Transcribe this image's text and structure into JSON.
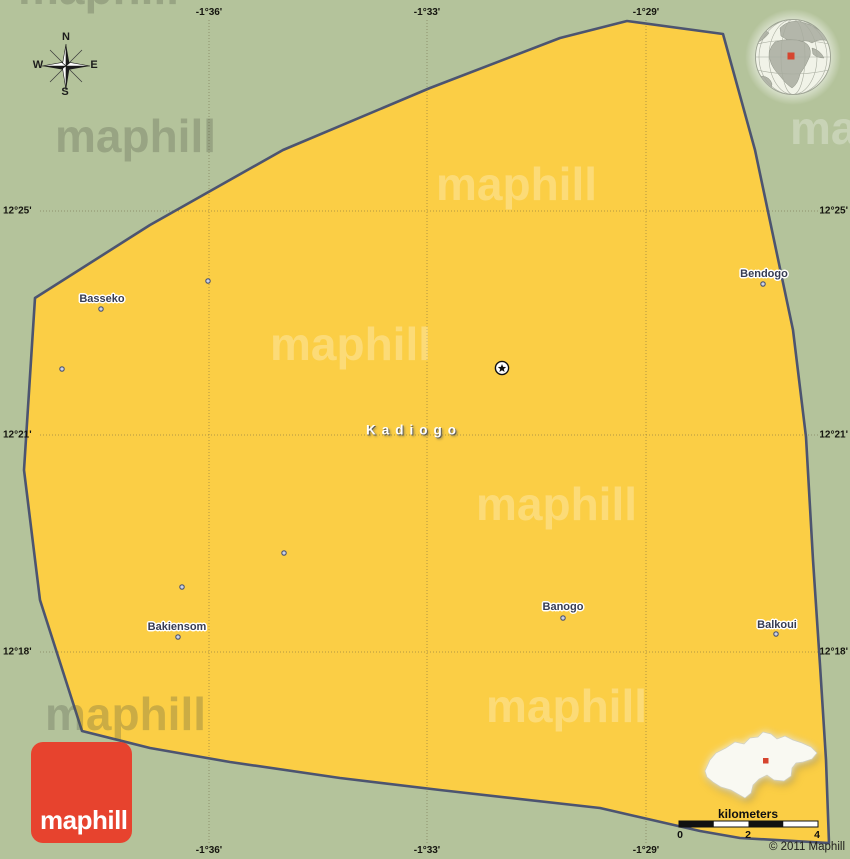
{
  "map": {
    "copyright": "© 2011 Maphill",
    "logo_text": "maphill",
    "watermark_text": "maphill"
  },
  "colors": {
    "background_green": "#b4c39b",
    "region_fill": "#fbce45",
    "region_border": "#4c5470",
    "gridline": "rgba(104,96,62,0.5)",
    "logo_red": "#e7432e",
    "marker_red": "#d6452f",
    "town_dot_fill": "#ccd2e8",
    "town_dot_ring": "#4a5270"
  },
  "compass": {
    "north": "N",
    "south": "S",
    "east": "E",
    "west": "W"
  },
  "grid": {
    "meridians": [
      {
        "label": "-1°36'",
        "x": 209
      },
      {
        "label": "-1°33'",
        "x": 427
      },
      {
        "label": "-1°29'",
        "x": 646
      }
    ],
    "parallels": [
      {
        "label": "12°25'",
        "y": 211
      },
      {
        "label": "12°21'",
        "y": 435
      },
      {
        "label": "12°18'",
        "y": 652
      }
    ]
  },
  "region": {
    "name": "Kadiogo",
    "label_x": 414,
    "label_y": 430
  },
  "capital_marker": {
    "type": "star-in-circle",
    "x": 502,
    "y": 368
  },
  "towns": [
    {
      "name": "Basseko",
      "label_x": 102,
      "label_y": 299,
      "dot_x": 101,
      "dot_y": 309
    },
    {
      "name": "Bendogo",
      "label_x": 764,
      "label_y": 274,
      "dot_x": 763,
      "dot_y": 284
    },
    {
      "name": "Banogo",
      "label_x": 563,
      "label_y": 607,
      "dot_x": 563,
      "dot_y": 618
    },
    {
      "name": "Balkoui",
      "label_x": 777,
      "label_y": 625,
      "dot_x": 776,
      "dot_y": 634
    },
    {
      "name": "Bakiensom",
      "label_x": 177,
      "label_y": 627,
      "dot_x": 178,
      "dot_y": 637
    }
  ],
  "unlabeled_dots": [
    {
      "x": 208,
      "y": 281
    },
    {
      "x": 62,
      "y": 369
    },
    {
      "x": 284,
      "y": 553
    },
    {
      "x": 182,
      "y": 587
    }
  ],
  "scale_bar": {
    "title": "kilometers",
    "ticks": [
      {
        "label": "0",
        "x": 680
      },
      {
        "label": "2",
        "x": 748
      },
      {
        "label": "4",
        "x": 817
      }
    ]
  },
  "watermarks": [
    {
      "x": 18,
      "y": -40,
      "tone": "dark"
    },
    {
      "x": 55,
      "y": 108,
      "tone": "dark"
    },
    {
      "x": 436,
      "y": 156,
      "tone": "light"
    },
    {
      "x": 790,
      "y": 100,
      "tone": "light"
    },
    {
      "x": 270,
      "y": 316,
      "tone": "light"
    },
    {
      "x": 476,
      "y": 476,
      "tone": "light"
    },
    {
      "x": 486,
      "y": 678,
      "tone": "light"
    },
    {
      "x": 45,
      "y": 686,
      "tone": "dark"
    }
  ]
}
